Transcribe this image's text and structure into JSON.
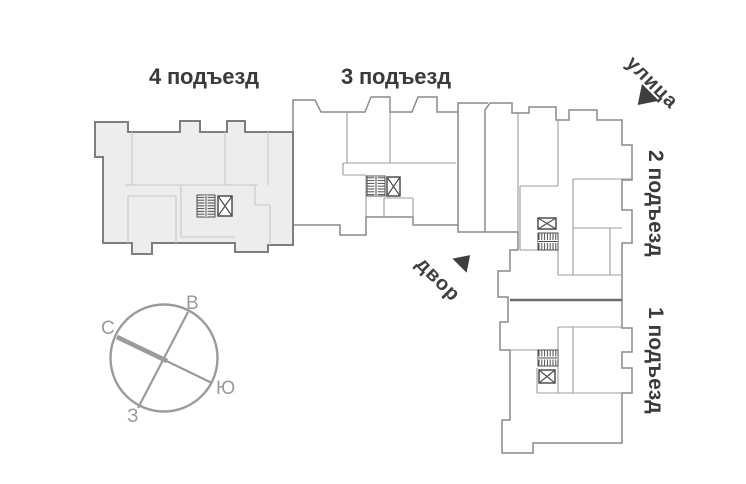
{
  "plan": {
    "entrances": [
      {
        "id": 4,
        "label": "4 подъезд",
        "highlighted": true
      },
      {
        "id": 3,
        "label": "3 подъезд",
        "highlighted": false
      },
      {
        "id": 2,
        "label": "2 подъезд",
        "highlighted": false
      },
      {
        "id": 1,
        "label": "1 подъезд",
        "highlighted": false
      }
    ],
    "street_label": "улица",
    "courtyard_label": "двор"
  },
  "compass": {
    "north": "С",
    "east": "В",
    "south": "Ю",
    "west": "З"
  },
  "icons": {
    "stairs": "stairs-icon",
    "elevator": "elevator-icon",
    "street_arrow": "street-direction-arrow",
    "courtyard_arrow": "courtyard-direction-arrow",
    "compass": "compass-rose"
  },
  "colors": {
    "highlighted_section_fill": "#ededed",
    "section_fill": "#ffffff",
    "outline": "#8a8a8a",
    "highlighted_outline": "#7e7e7e",
    "interior_wall_light": "#c7c7c7",
    "interior_wall": "#9c9c9c",
    "divider_wall": "#6e6e6e",
    "icon": "#4f4f4f",
    "label_text": "#3a3a3a",
    "arrow": "#3f3f3f",
    "compass": "#9b9b9b",
    "background": "#ffffff"
  }
}
